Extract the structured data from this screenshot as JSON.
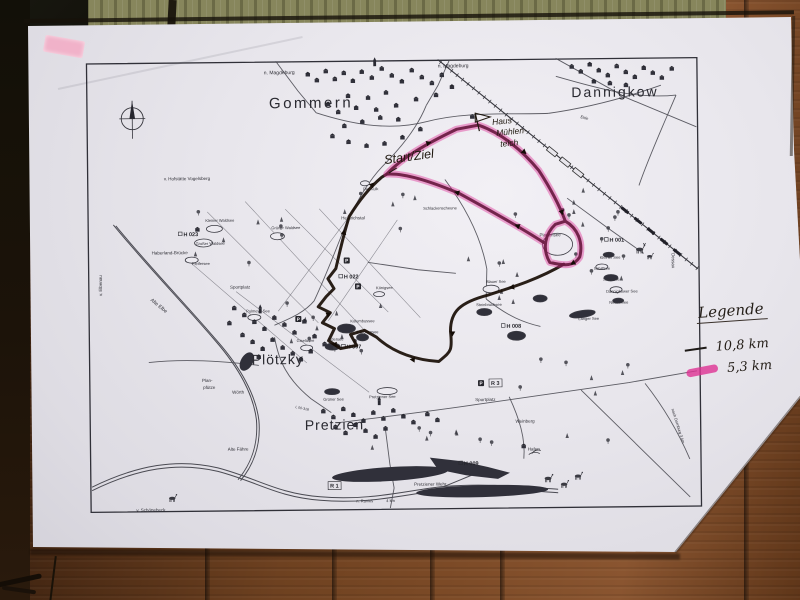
{
  "legend": {
    "title": "Legende",
    "items": [
      {
        "distance": "10,8 km",
        "color": "#1f1b18",
        "style": "thin-black-line"
      },
      {
        "distance": "5,3 km",
        "color": "#df3294",
        "style": "pink-highlighter"
      }
    ]
  },
  "handwritten": {
    "start_label": "Start/Ziel",
    "house_label_lines": [
      "Haus",
      "Mühlen-",
      "teich"
    ]
  },
  "map": {
    "towns": [
      {
        "text": "Gommern",
        "x": 225,
        "y": 47,
        "size": 15,
        "ls": 2.5
      },
      {
        "text": "Dannigkow",
        "x": 529,
        "y": 39,
        "size": 14,
        "ls": 2
      },
      {
        "text": "Plötzky",
        "x": 189,
        "y": 303,
        "size": 14,
        "ls": 1
      },
      {
        "text": "Pretzien",
        "x": 245,
        "y": 369,
        "size": 14,
        "ls": 1
      }
    ],
    "places": [
      {
        "text": "n. Magdeburg",
        "x": 178,
        "y": 13,
        "s": 5
      },
      {
        "text": "n. Magdeburg",
        "x": 352,
        "y": 8,
        "s": 5
      },
      {
        "text": "v. Hofstätte Vogelsberg",
        "x": 77,
        "y": 118,
        "s": 4.5
      },
      {
        "text": "Haberland-Brücke",
        "x": 64,
        "y": 192,
        "s": 4.5
      },
      {
        "text": "v. Elbenau",
        "x": 14,
        "y": 233,
        "s": 4.5,
        "rot": -90
      },
      {
        "text": "Alte Elbe",
        "x": 62,
        "y": 238,
        "s": 5,
        "rot": 40
      },
      {
        "text": "Der Kulk",
        "x": 276,
        "y": 130,
        "s": 4
      },
      {
        "text": "Heinrichstal",
        "x": 254,
        "y": 159,
        "s": 4.5
      },
      {
        "text": "Schlackenscheune",
        "x": 336,
        "y": 150,
        "s": 4
      },
      {
        "text": "Kleiner Waldsee",
        "x": 118,
        "y": 160,
        "s": 4
      },
      {
        "text": "Großer Waldsee",
        "x": 108,
        "y": 183,
        "s": 4
      },
      {
        "text": "Pfeifersee",
        "x": 104,
        "y": 203,
        "s": 4
      },
      {
        "text": "Grüner Waldsee",
        "x": 184,
        "y": 168,
        "s": 4
      },
      {
        "text": "Sportplatz",
        "x": 142,
        "y": 227,
        "s": 4.5
      },
      {
        "text": "Pulmeys See",
        "x": 158,
        "y": 251,
        "s": 4
      },
      {
        "text": "Königsee",
        "x": 288,
        "y": 229,
        "s": 4
      },
      {
        "text": "Kolumbussee",
        "x": 262,
        "y": 262,
        "s": 4
      },
      {
        "text": "Märchensee",
        "x": 268,
        "y": 273,
        "s": 4
      },
      {
        "text": "Giselasee",
        "x": 208,
        "y": 281,
        "s": 4
      },
      {
        "text": "Edersee",
        "x": 240,
        "y": 280,
        "s": 4
      },
      {
        "text": "Blauer See",
        "x": 398,
        "y": 224,
        "s": 4
      },
      {
        "text": "Steinbruchsee",
        "x": 388,
        "y": 247,
        "s": 4
      },
      {
        "text": "Langer See",
        "x": 490,
        "y": 262,
        "s": 4
      },
      {
        "text": "Plattensee",
        "x": 452,
        "y": 178,
        "s": 4.5
      },
      {
        "text": "Kleiner See",
        "x": 512,
        "y": 201,
        "s": 4
      },
      {
        "text": "Schilfsee",
        "x": 506,
        "y": 212,
        "s": 4
      },
      {
        "text": "Silbersee",
        "x": 515,
        "y": 223,
        "s": 4
      },
      {
        "text": "Dannigkower See",
        "x": 518,
        "y": 235,
        "s": 4
      },
      {
        "text": "Neuer See",
        "x": 521,
        "y": 246,
        "s": 4
      },
      {
        "text": "Wörth",
        "x": 143,
        "y": 332,
        "s": 4.5
      },
      {
        "text": "Plan-",
        "x": 113,
        "y": 320,
        "s": 4.5
      },
      {
        "text": "pfütze",
        "x": 114,
        "y": 327,
        "s": 4.5
      },
      {
        "text": "Grüner See",
        "x": 234,
        "y": 340,
        "s": 4
      },
      {
        "text": "Pretziener See",
        "x": 280,
        "y": 338,
        "s": 4
      },
      {
        "text": "Sportplatz",
        "x": 386,
        "y": 342,
        "s": 4.5
      },
      {
        "text": "Weinberg",
        "x": 426,
        "y": 364,
        "s": 4.5
      },
      {
        "text": "Hafen",
        "x": 438,
        "y": 392,
        "s": 4.5
      },
      {
        "text": "Alte Fähre",
        "x": 138,
        "y": 389,
        "s": 4.5
      },
      {
        "text": "v. Schönebeck",
        "x": 46,
        "y": 449,
        "s": 4.5
      },
      {
        "text": "Pretziener Wehr",
        "x": 324,
        "y": 426,
        "s": 4.5
      },
      {
        "text": "n. Ranies",
        "x": 266,
        "y": 442,
        "s": 4
      },
      {
        "text": "4 km",
        "x": 296,
        "y": 442,
        "s": 4
      },
      {
        "text": "Dessau",
        "x": 584,
        "y": 196,
        "s": 4.5,
        "rot": 90
      },
      {
        "text": "nach Dornburg 3 km",
        "x": 582,
        "y": 352,
        "s": 4,
        "rot": 73
      },
      {
        "text": "Ehle",
        "x": 494,
        "y": 60,
        "s": 4,
        "rot": 15
      },
      {
        "text": "L 00-318",
        "x": 206,
        "y": 347,
        "s": 3.5,
        "rot": 12
      }
    ],
    "trail_markers": [
      {
        "text": "H 023",
        "x": 96,
        "y": 174
      },
      {
        "text": "H 022",
        "x": 256,
        "y": 218
      },
      {
        "text": "H 007",
        "x": 258,
        "y": 288
      },
      {
        "text": "H 008",
        "x": 418,
        "y": 269
      },
      {
        "text": "H 001",
        "x": 522,
        "y": 184
      },
      {
        "text": "H 009",
        "x": 374,
        "y": 406
      },
      {
        "text": "R 3",
        "x": 402,
        "y": 326,
        "boxed": true
      },
      {
        "text": "R 1",
        "x": 240,
        "y": 427,
        "boxed": true
      }
    ],
    "parking_symbol": "P",
    "parking": [
      {
        "x": 259,
        "y": 200
      },
      {
        "x": 270,
        "y": 226
      },
      {
        "x": 210,
        "y": 258
      },
      {
        "x": 392,
        "y": 324
      }
    ]
  },
  "colors": {
    "route_ink": "#1a0f08",
    "route_highlight": "#de2c94",
    "map_ink": "#35353c",
    "paper": "#e7e5eb",
    "wood": "#6e4120",
    "olive_band": "#87865c"
  }
}
